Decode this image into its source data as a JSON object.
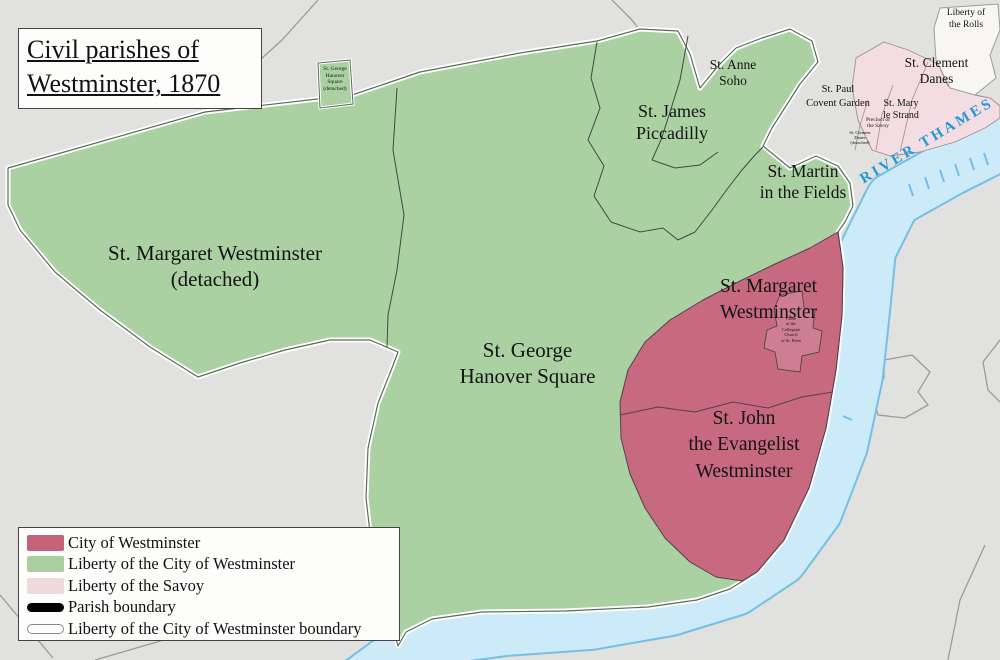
{
  "title": {
    "line1": "Civil parishes of",
    "line2": "Westminster, 1870"
  },
  "map_labels": {
    "st_margaret_detached": {
      "l1": "St. Margaret Westminster",
      "l2": "(detached)"
    },
    "st_george": {
      "l1": "St. George",
      "l2": "Hanover Square"
    },
    "st_george_detached": {
      "l1": "St. George",
      "l2": "Hanover",
      "l3": "Square",
      "l4": "(detached)"
    },
    "st_james": {
      "l1": "St. James",
      "l2": "Piccadilly"
    },
    "st_anne": {
      "l1": "St. Anne",
      "l2": "Soho"
    },
    "st_martin": {
      "l1": "St. Martin",
      "l2": "in the Fields"
    },
    "st_paul": {
      "l1": "St. Paul",
      "l2": "Covent Garden"
    },
    "st_clement": {
      "l1": "St. Clement",
      "l2": "Danes"
    },
    "st_mary": {
      "l1": "St. Mary",
      "l2": "le Strand"
    },
    "liberty_rolls": {
      "l1": "Liberty of",
      "l2": "the Rolls"
    },
    "savoy_precinct": {
      "l1": "Precinct of",
      "l2": "the Savoy"
    },
    "st_clement_detached": {
      "l1": "St. Clement",
      "l2": "Danes",
      "l3": "(detached)"
    },
    "st_margaret": {
      "l1": "St. Margaret",
      "l2": "Westminster"
    },
    "st_john": {
      "l1": "St. John",
      "l2": "the Evangelist",
      "l3": "Westminster"
    },
    "abbey_close": {
      "l1": "Close",
      "l2": "of the",
      "l3": "Collegiate",
      "l4": "Church",
      "l5": "of St. Peter"
    },
    "river": "RIVER THAMES"
  },
  "legend": {
    "items": [
      {
        "label": "City of Westminster",
        "swatch": "#c2637b",
        "type": "fill"
      },
      {
        "label": "Liberty of the City of Westminster",
        "swatch": "#a9cfa1",
        "type": "fill"
      },
      {
        "label": "Liberty of the Savoy",
        "swatch": "#eed9df",
        "type": "fill"
      },
      {
        "label": "Parish boundary",
        "swatch": "#000000",
        "type": "line"
      },
      {
        "label": "Liberty of the City of Westminster boundary",
        "swatch": "#ffffff",
        "type": "outline"
      }
    ]
  },
  "colors": {
    "background": "#e1e1df",
    "liberty_green": "#abd1a3",
    "city_red": "#c7697f",
    "savoy_pink": "#f4dde2",
    "river_fill": "#cdeaf9",
    "river_edge": "#74bfe6",
    "river_text": "#1d9ad6",
    "outside_boundary": "#9b9b98",
    "parish_boundary": "#3f4a3f"
  }
}
